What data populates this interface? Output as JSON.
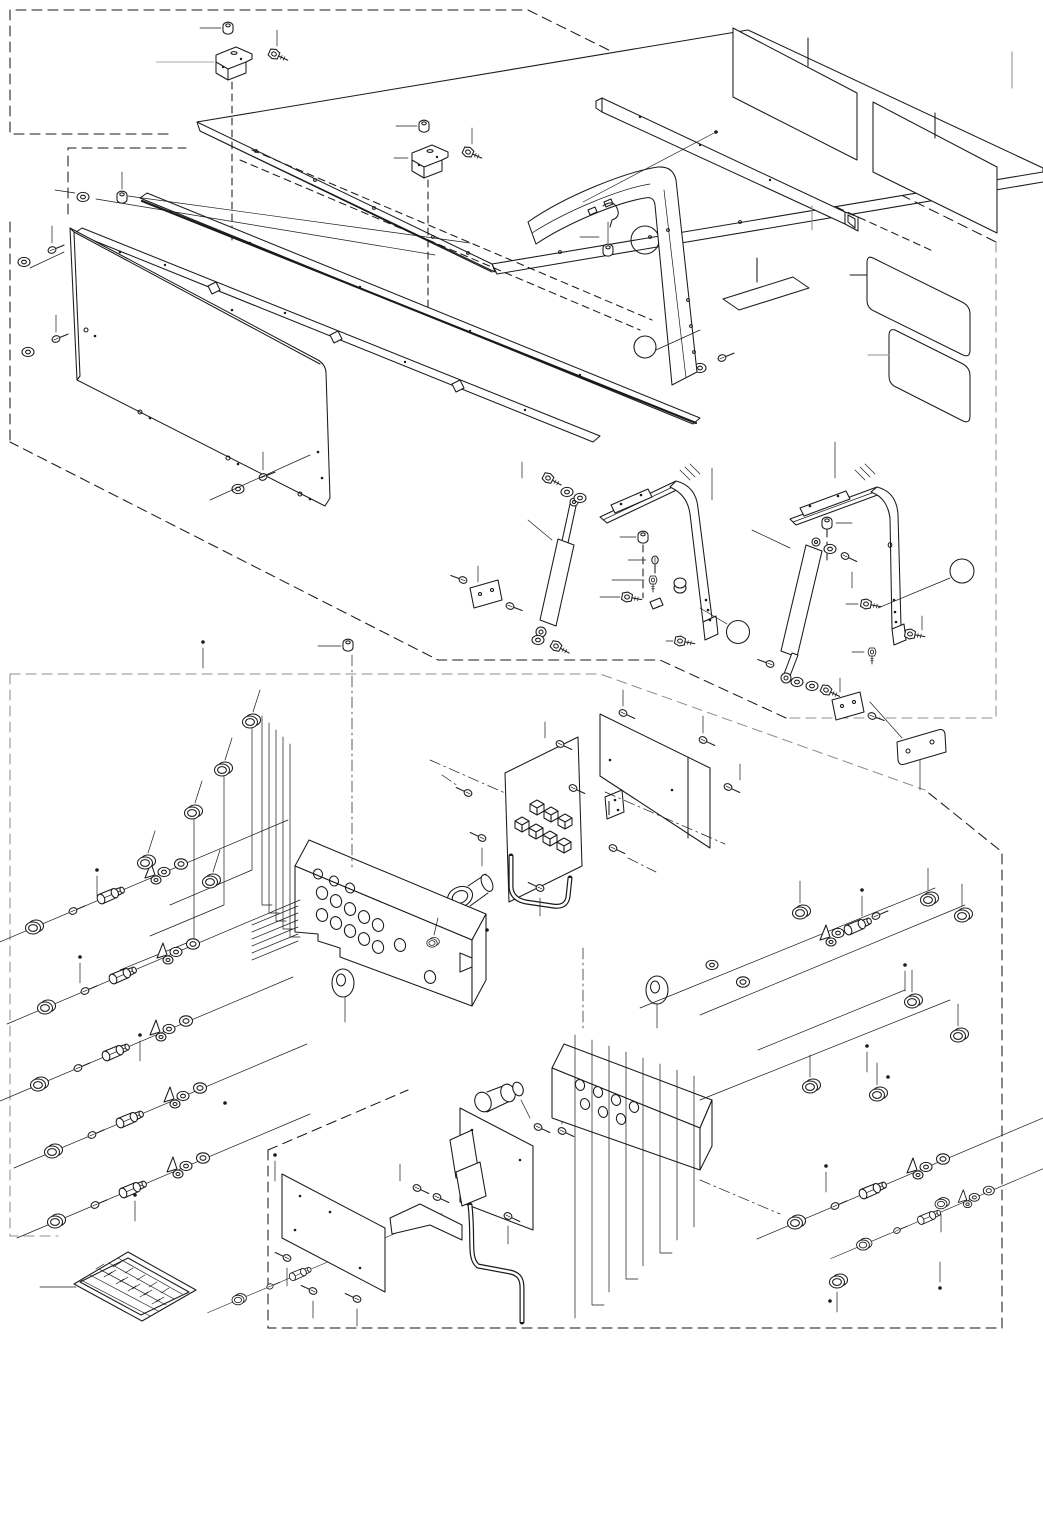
{
  "page": {
    "title": "Exploded parts diagram - canopy, gas struts and control panel",
    "background": "#ffffff",
    "colors": {
      "ink": "#1a1a1a",
      "muted": "#8f8f8f"
    },
    "canvas": {
      "width": 1043,
      "height": 1536
    },
    "text_visible_on_sheet": false
  },
  "diagram": {
    "type": "exploded-parts-diagram",
    "style": "isometric black line art with dashed group boundaries, leader lines, blank callout balloons and blank decals",
    "balloons": [
      {
        "label": ""
      },
      {
        "label": ""
      }
    ],
    "decals": {
      "blank_rectangular_labels": 5,
      "table_decal": {
        "description": "small isometric grid/table decal, text not legible",
        "leader": true
      }
    },
    "assemblies": [
      {
        "name": "canopy-roof-panel",
        "parts": [
          "roof panel",
          "z-bracket x2",
          "cap nut x2",
          "flange bolt x2"
        ]
      },
      {
        "name": "roof-rails",
        "parts": [
          "front rail",
          "seal strip rail",
          "washer-nut set x3"
        ]
      },
      {
        "name": "side-panel",
        "parts": [
          "large side panel",
          "bolt-washer set x4"
        ]
      },
      {
        "name": "side-frame",
        "parts": [
          "curved corner frame",
          "latch striker",
          "bolt"
        ]
      },
      {
        "name": "rear-square-tube",
        "parts": [
          "square tube"
        ]
      },
      {
        "name": "gas-strut-left",
        "parts": [
          "gas spring",
          "upper channel",
          "curved leg",
          "foot bracket",
          "cap nut",
          "washers",
          "bolts"
        ],
        "balloon_index": 0
      },
      {
        "name": "gas-strut-right",
        "parts": [
          "gas spring",
          "upper channel",
          "curved leg",
          "foot bracket",
          "cap nut",
          "washers",
          "bolts"
        ],
        "balloon_index": 1
      },
      {
        "name": "relay-box",
        "parts": [
          "relay plate",
          "relay cube x7",
          "cover panel",
          "u-bracket",
          "buzzer",
          "screws",
          "wire loop"
        ]
      },
      {
        "name": "control-panel",
        "parts": [
          "panel housing",
          "grommet x2",
          "switch assembly x6",
          "blanking cap x8",
          "harness step lines"
        ]
      },
      {
        "name": "switch-bank-right",
        "parts": [
          "holed bracket",
          "switch assembly x4",
          "blanking cap x10",
          "harness lines"
        ]
      },
      {
        "name": "power-cable",
        "parts": [
          "mount plate x2",
          "connector plug",
          "cord",
          "power socket"
        ]
      },
      {
        "name": "small-mount-plate",
        "parts": [
          "plate with two holes"
        ]
      }
    ]
  }
}
